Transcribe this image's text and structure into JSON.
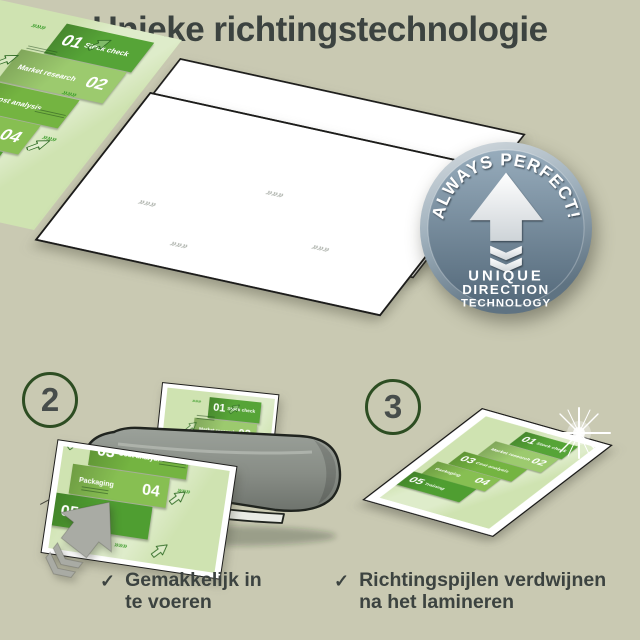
{
  "title": "Unieke richtingstechnologie",
  "panels": {
    "p1": "1",
    "p2": "2",
    "p3": "3"
  },
  "badge": {
    "arc_text": "ALWAYS PERFECT!",
    "lines": [
      "UNIQUE",
      "DIRECTION",
      "TECHNOLOGY"
    ]
  },
  "document": {
    "launch_label": "Launch",
    "watermark_glyph": "»»»",
    "steps": [
      {
        "num": "01",
        "label": "Stock check",
        "color": "#56a437"
      },
      {
        "num": "02",
        "label": "Market research",
        "color": "#9cca6e"
      },
      {
        "num": "03",
        "label": "Cost analysis",
        "color": "#74b441"
      },
      {
        "num": "04",
        "label": "Packaging",
        "color": "#87bf52"
      },
      {
        "num": "05",
        "label": "Training",
        "color": "#4f9e31"
      }
    ]
  },
  "notes": [
    {
      "check": "✓",
      "text": "Gemakkelijk in te voeren"
    },
    {
      "check": "✓",
      "text": "Richtingspijlen verdwijnen na het lamineren"
    }
  ],
  "colors": {
    "page_bg": "#c9c9b2",
    "ink": "#3c4340",
    "circle_ring": "#2d4d22",
    "doc_bg": "#cfe3b1",
    "green_accent": "#3f9e2e",
    "badge_rim": "#7d91a1",
    "badge_inner_top": "#97acbc",
    "badge_inner_bottom": "#54697a",
    "machine_gray": "#8f938e",
    "arrow_gray": "#a9aba4"
  }
}
